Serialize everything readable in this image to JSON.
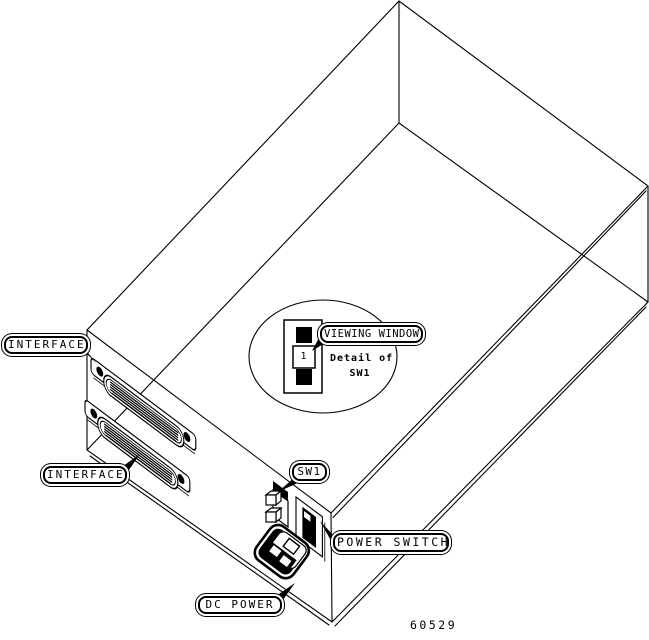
{
  "figure_number": "60529",
  "callouts": {
    "interface_top": "INTERFACE",
    "interface_bottom": "INTERFACE",
    "sw1": "SW1",
    "viewing_window": "VIEWING WINDOW",
    "power_switch": "POWER SWITCH",
    "dc_power": "DC POWER"
  },
  "detail_balloon": {
    "caption_line1": "Detail of",
    "caption_line2": "SW1",
    "switch_window_value": "1"
  },
  "colors": {
    "ink": "#000000",
    "paper": "#ffffff"
  }
}
